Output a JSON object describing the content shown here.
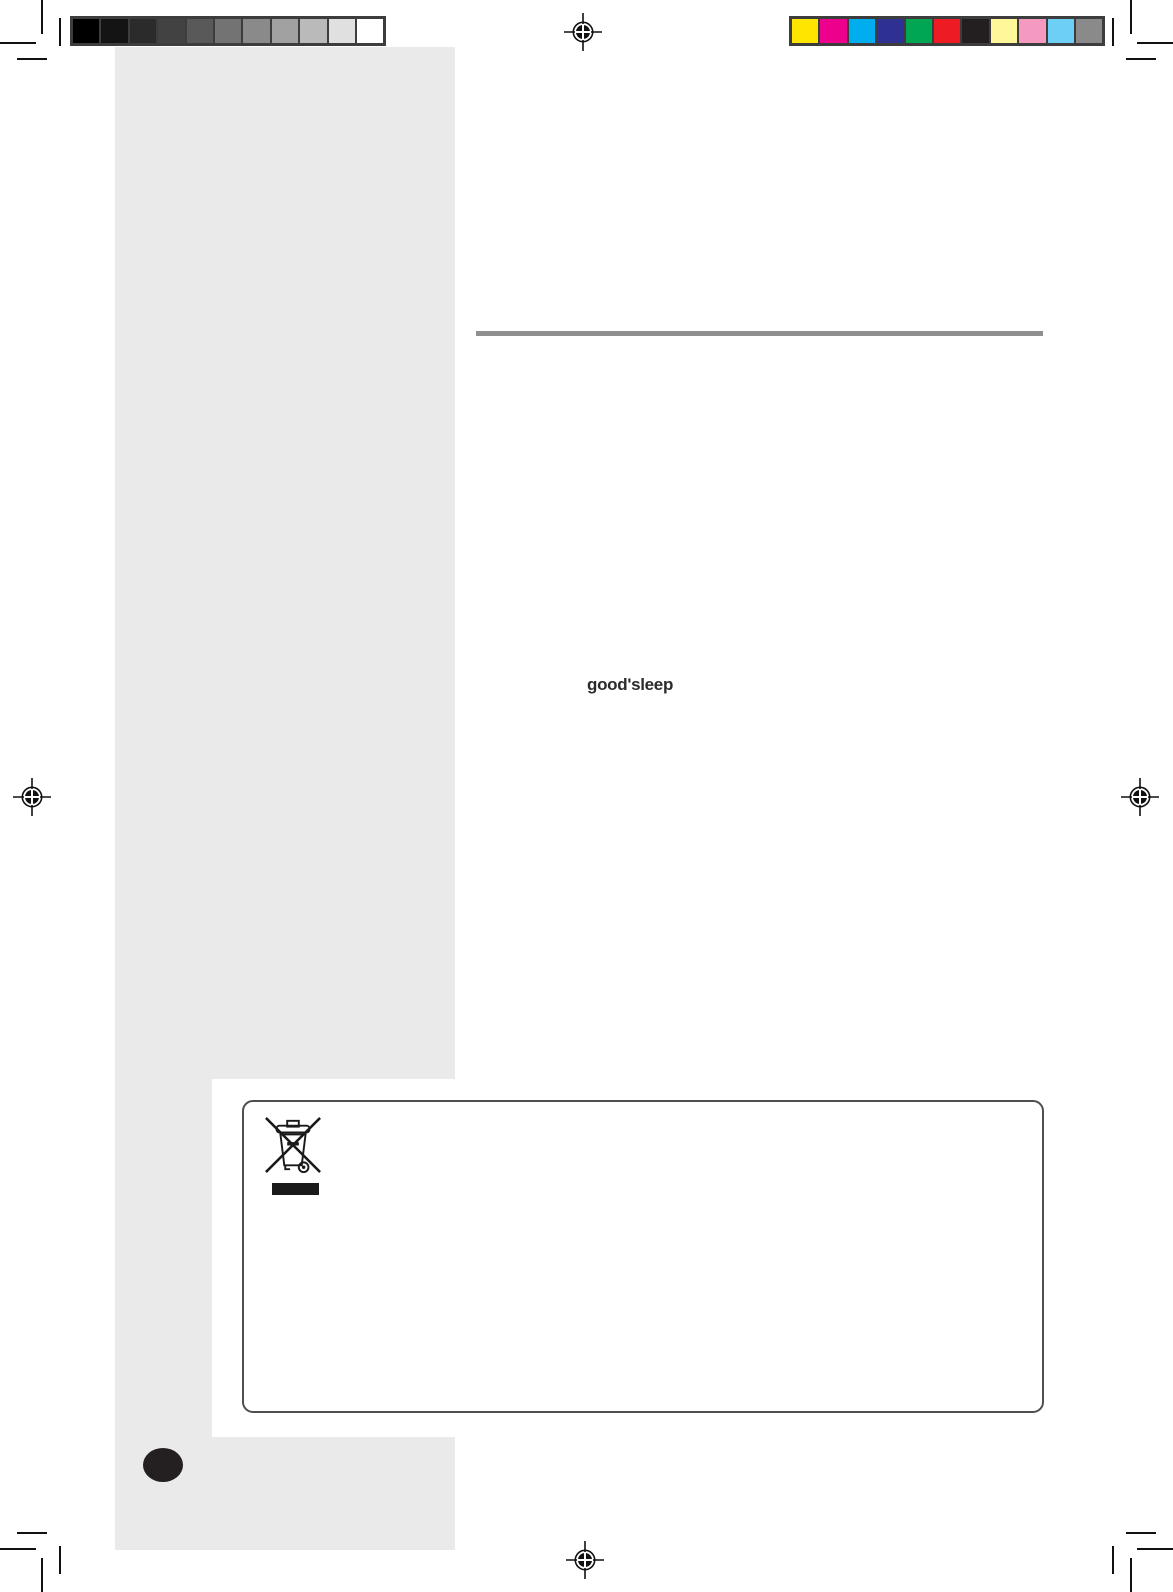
{
  "document": {
    "type": "scanned-manual-page",
    "brand_text": "good'sleep",
    "page_background": "#ffffff",
    "sidebar_color": "#eaeaea",
    "divider_color": "#8f8f8f"
  },
  "prepress": {
    "mark_color": "#111111",
    "grayscale_bar_colors": [
      "#000000",
      "#141414",
      "#2b2b2b",
      "#424242",
      "#595959",
      "#737373",
      "#8a8a8a",
      "#a1a1a1",
      "#bababa",
      "#e0e0e0",
      "#ffffff"
    ],
    "color_bar_colors": [
      "#ffe600",
      "#ec008c",
      "#00aeef",
      "#2e3192",
      "#00a651",
      "#ed1c24",
      "#231f20",
      "#fff799",
      "#f49ac1",
      "#6dcff6",
      "#8a8a8a"
    ]
  },
  "weee_box": {
    "symbol_name": "weee-crossed-out-wheeled-bin-icon",
    "border_color": "#4f4f4f",
    "bar_color": "#1a1a1a"
  },
  "page_marker": {
    "color": "#241f20"
  }
}
